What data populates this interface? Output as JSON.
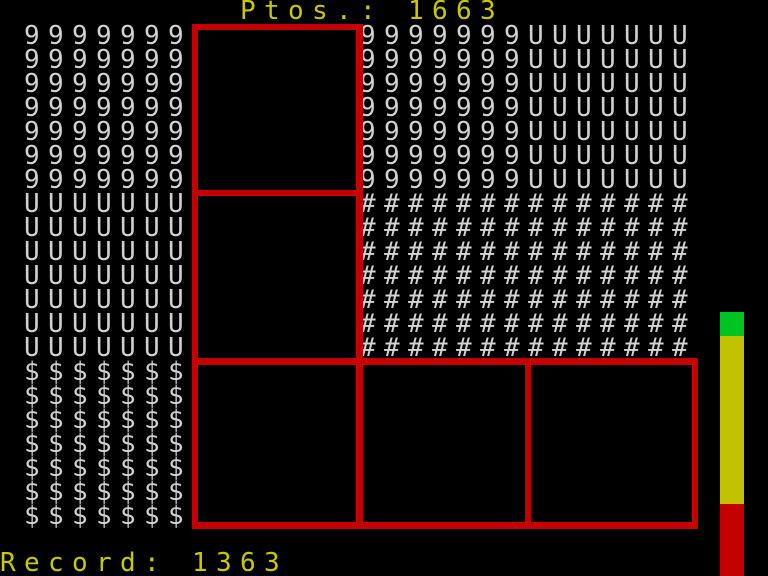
{
  "score": {
    "label": "Ptos.:",
    "value": "1663"
  },
  "record": {
    "label": "Record:",
    "value": "1363"
  },
  "board": {
    "blocks": {
      "nines_left": {
        "char": "9",
        "cols": 7,
        "rows": 7
      },
      "us_left": {
        "char": "U",
        "cols": 7,
        "rows": 7
      },
      "dollars_left": {
        "char": "$",
        "cols": 7,
        "rows": 7
      },
      "nines_right": {
        "char": "9",
        "cols": 7,
        "rows": 7
      },
      "us_right": {
        "char": "U",
        "cols": 7,
        "rows": 7
      },
      "hashes": {
        "char": "#",
        "cols": 14,
        "rows": 7
      }
    },
    "empty_boxes_count": 5
  },
  "meter": {
    "segments": [
      {
        "name": "green",
        "color": "#00C422"
      },
      {
        "name": "yellow",
        "color": "#C2C200"
      },
      {
        "name": "red",
        "color": "#C40000"
      }
    ]
  },
  "colors": {
    "background": "#000000",
    "glyph_gray": "#D2D2D2",
    "accent_yellow": "#C9C900",
    "box_red": "#C40000"
  }
}
